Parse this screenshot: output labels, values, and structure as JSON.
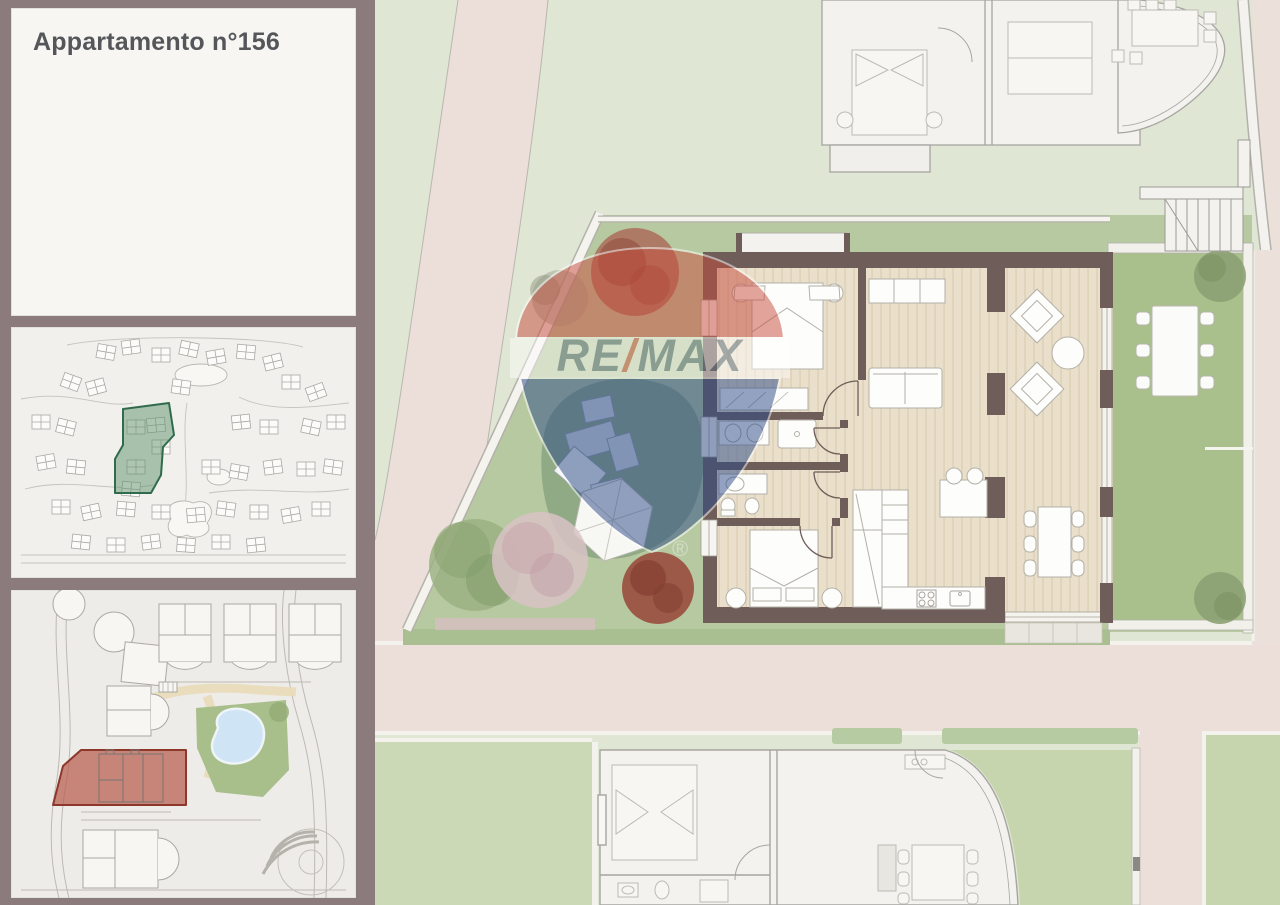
{
  "title_panel": {
    "title": "Appartamento n°156"
  },
  "watermark": {
    "re": "RE",
    "slash": "/",
    "max": "MAX",
    "registered": "®"
  },
  "colors": {
    "frame": "#8B7B7D",
    "panel_bg": "#F7F6F3",
    "title_text": "#54565A",
    "lawn": "#DFE6D3",
    "road": "#ECDFD9",
    "plot_green": "#B7C9A0",
    "private_garden_green": "#A9BF8C",
    "mound_green": "#8BA681",
    "hedge_green": "#A9BF92",
    "wall": "#6E5D58",
    "wood_floor": "#E9DFCA",
    "furniture_white": "#FDFDFB",
    "neighbor_outline": "#A6A5A0",
    "pool_blue": "#CFE4F4",
    "remax_red": "#C94C3E",
    "remax_blue": "#2C4A88",
    "remax_text_gray": "#5E7383",
    "highlight_green_fill": "#5E926B",
    "highlight_green_stroke": "#2F6B4C",
    "highlight_red_fill": "#B85C4C",
    "highlight_red_stroke": "#8E372B"
  }
}
